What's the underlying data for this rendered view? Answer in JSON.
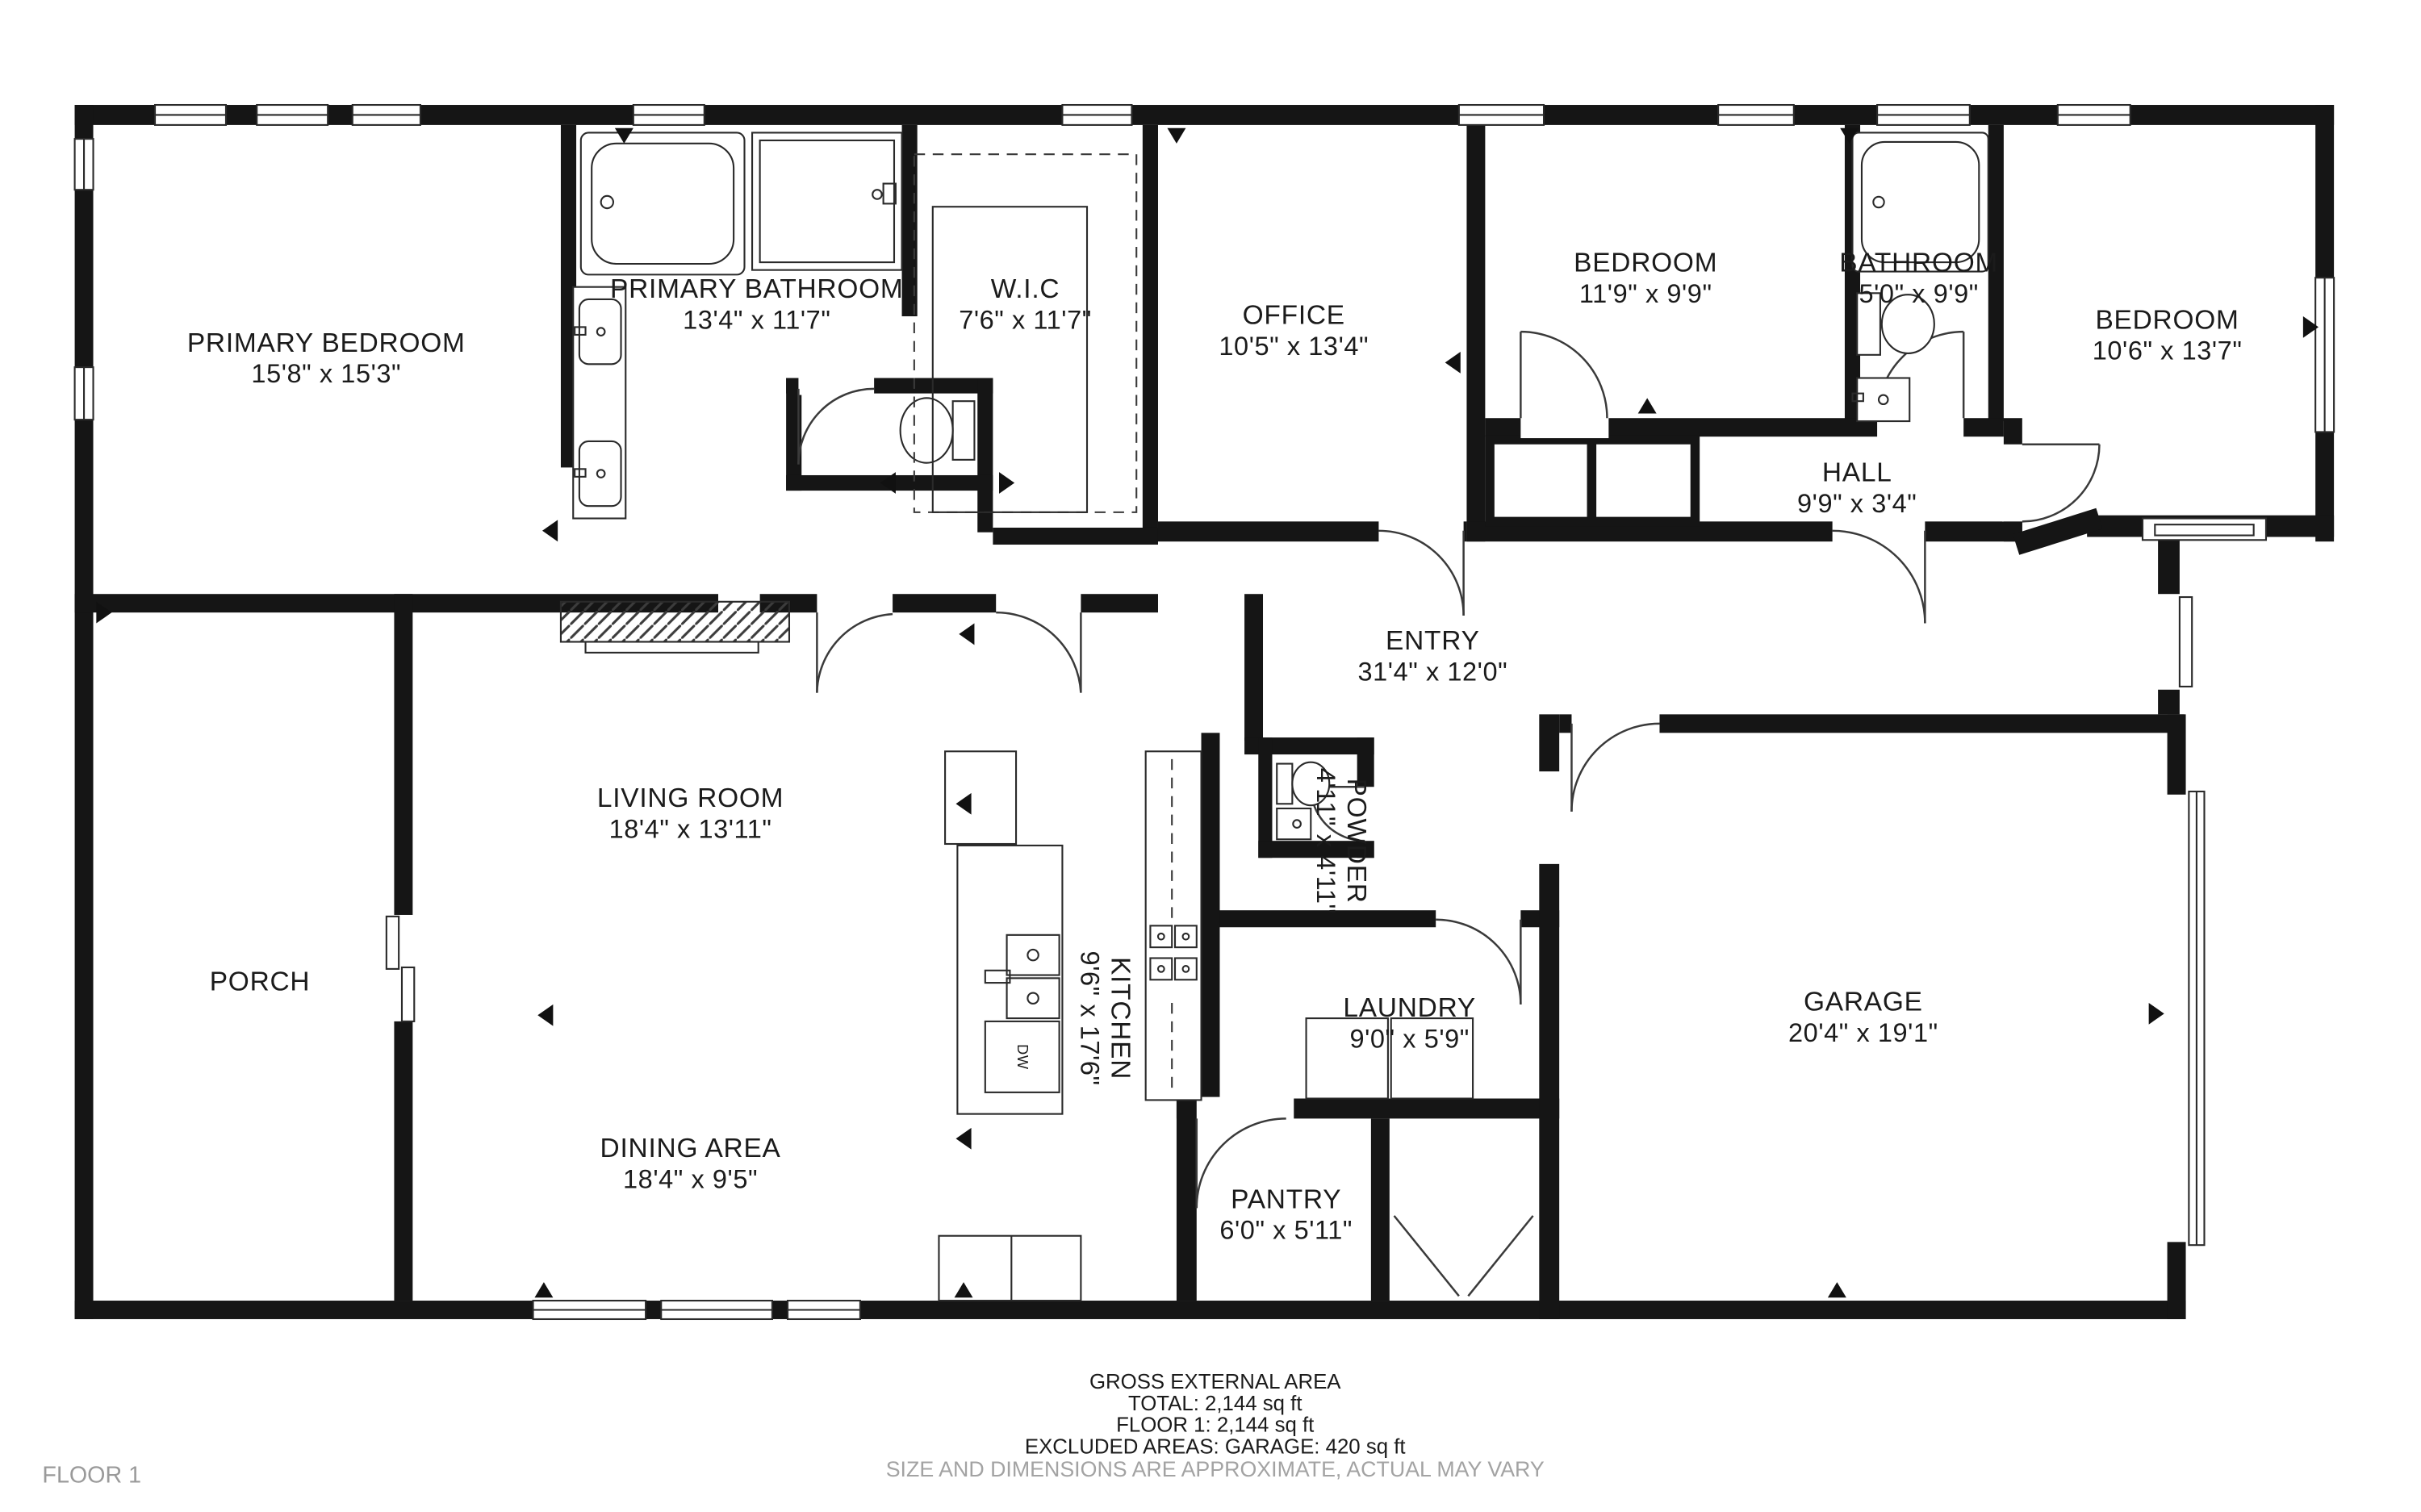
{
  "rooms": {
    "primary_bedroom": {
      "name": "PRIMARY BEDROOM",
      "dims": "15'8\" x 15'3\""
    },
    "primary_bathroom": {
      "name": "PRIMARY BATHROOM",
      "dims": "13'4\" x 11'7\""
    },
    "wic": {
      "name": "W.I.C",
      "dims": "7'6\" x 11'7\""
    },
    "office": {
      "name": "OFFICE",
      "dims": "10'5\" x 13'4\""
    },
    "bedroom_1": {
      "name": "BEDROOM",
      "dims": "11'9\" x 9'9\""
    },
    "bathroom": {
      "name": "BATHROOM",
      "dims": "5'0\" x 9'9\""
    },
    "bedroom_2": {
      "name": "BEDROOM",
      "dims": "10'6\" x 13'7\""
    },
    "hall": {
      "name": "HALL",
      "dims": "9'9\" x 3'4\""
    },
    "entry": {
      "name": "ENTRY",
      "dims": "31'4\" x 12'0\""
    },
    "living_room": {
      "name": "LIVING ROOM",
      "dims": "18'4\" x 13'11\""
    },
    "porch": {
      "name": "PORCH",
      "dims": ""
    },
    "kitchen": {
      "name": "KITCHEN",
      "dims": "9'6\" x 17'6\""
    },
    "powder": {
      "name": "POWDER",
      "dims": "4'11\" x 4'11\""
    },
    "laundry": {
      "name": "LAUNDRY",
      "dims": "9'0\" x 5'9\""
    },
    "dining_area": {
      "name": "DINING AREA",
      "dims": "18'4\" x 9'5\""
    },
    "pantry": {
      "name": "PANTRY",
      "dims": "6'0\" x 5'11\""
    },
    "garage": {
      "name": "GARAGE",
      "dims": "20'4\" x 19'1\""
    }
  },
  "fixtures": {
    "dishwasher_label": "DW"
  },
  "footer": {
    "area_title": "GROSS EXTERNAL AREA",
    "total": "TOTAL: 2,144 sq ft",
    "floor_total": "FLOOR 1: 2,144 sq ft",
    "excluded": "EXCLUDED AREAS: GARAGE: 420 sq ft",
    "disclaimer": "SIZE AND DIMENSIONS ARE APPROXIMATE, ACTUAL MAY VARY"
  },
  "floor_label": "FLOOR 1"
}
